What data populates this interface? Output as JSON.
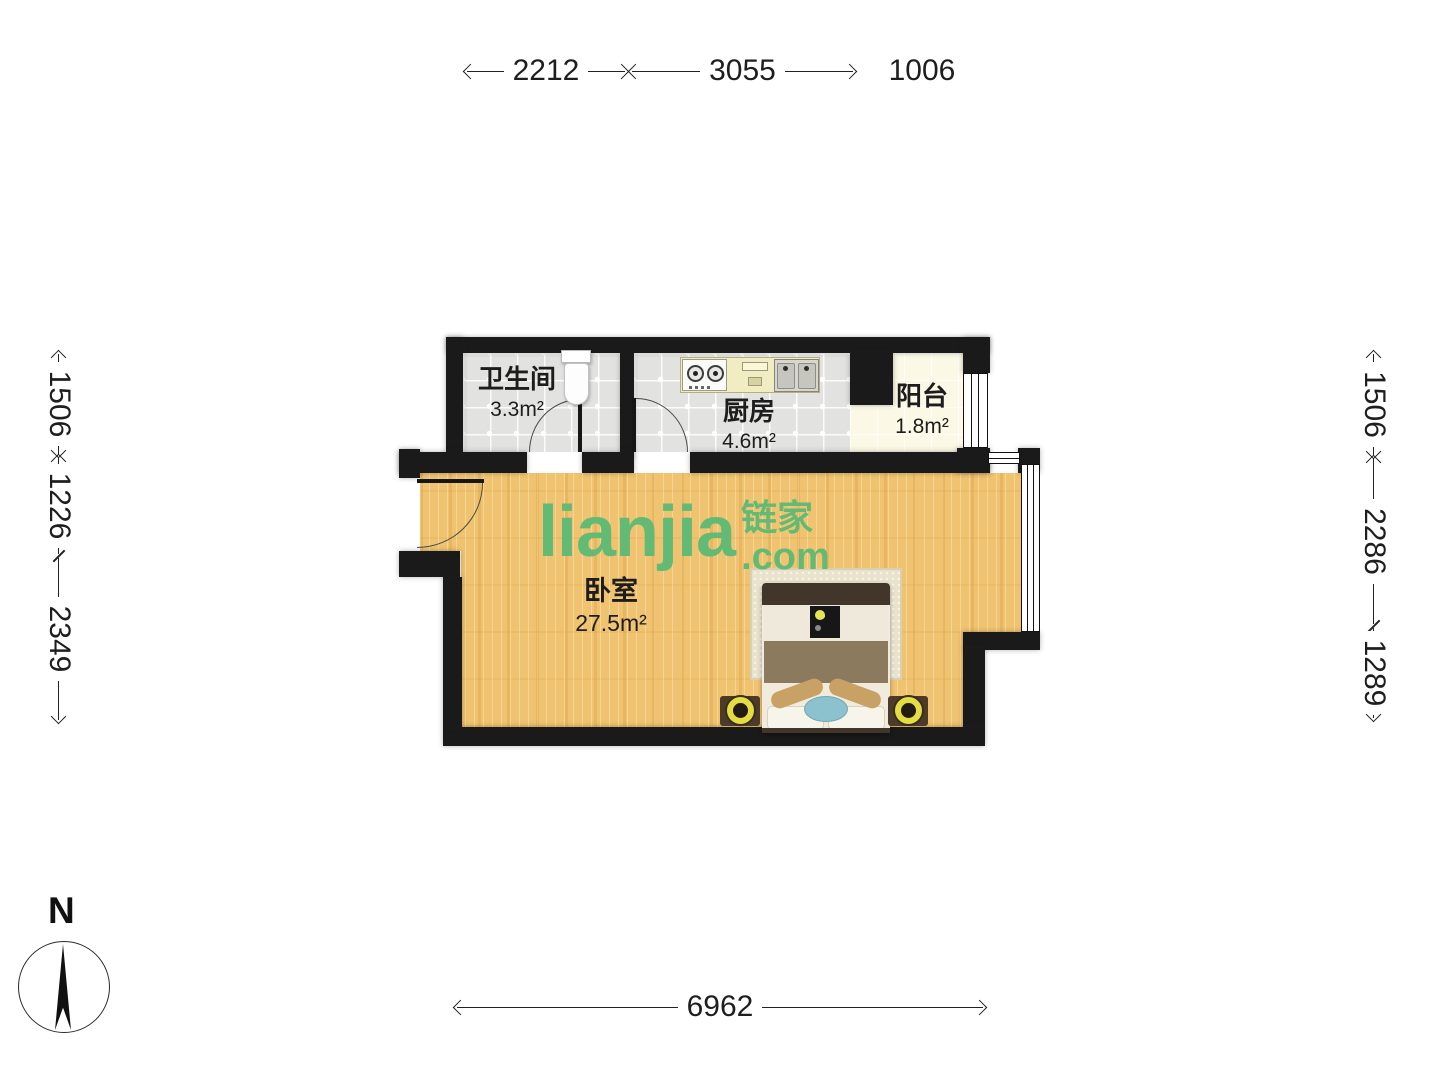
{
  "watermark": {
    "logo": "LIANJIA",
    "cjk": "链家",
    "domain": ".com",
    "green": "#63ba74"
  },
  "compass": {
    "north_label": "N"
  },
  "rooms": [
    {
      "name": "卫生间",
      "area": "3.3m²"
    },
    {
      "name": "厨房",
      "area": "4.6m²"
    },
    {
      "name": "阳台",
      "area": "1.8m²"
    },
    {
      "name": "卧室",
      "area": "27.5m²"
    }
  ],
  "dimensions": {
    "top": [
      "2212",
      "3055",
      "1006"
    ],
    "left": [
      "1506",
      "1226",
      "2349"
    ],
    "right": [
      "1506",
      "2286",
      "1289"
    ],
    "bottom": [
      "6962"
    ]
  },
  "colors": {
    "wall": "#1a1a1a",
    "wood_floor": "#efc36f",
    "tile_floor": "#e2e2e0",
    "balcony_floor": "#fbf8e5",
    "watermark_green": "#63ba74"
  }
}
